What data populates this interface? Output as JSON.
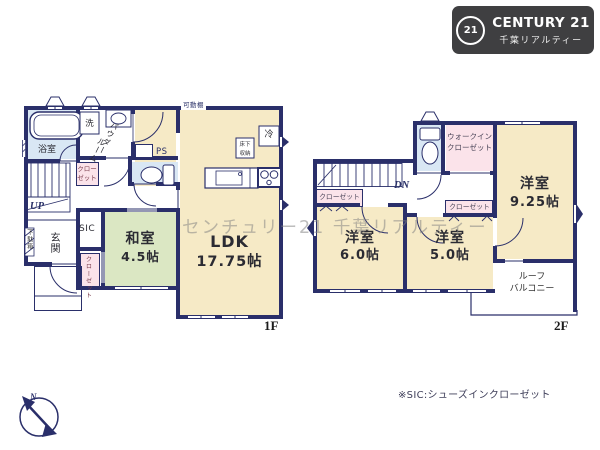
{
  "logo": {
    "seal": "21",
    "brand": "CENTURY 21",
    "subtitle": "千葉リアルティー"
  },
  "watermark": "センチュリー21 千葉リアルティー",
  "footnote": "※SIC:シューズインクローゼット",
  "compass": {
    "north": "N"
  },
  "colors": {
    "wall": "#2a2f6a",
    "room_cream": "#f6eac6",
    "room_green": "#dbe7c3",
    "room_blue": "#d9e7f4",
    "room_pink": "#fbe3ea",
    "logo_bg": "#3f3f41"
  },
  "icons": {
    "compass": "compass-icon",
    "bathtub": "bathtub-icon",
    "toilet": "toilet-icon",
    "kitchen": "kitchen-counter-icon",
    "stove": "stove-icon",
    "sink": "sink-icon"
  },
  "floor1": {
    "floor_label": "1F",
    "bath": "浴室",
    "laundry": "洗",
    "powder_line1": "パウダー",
    "powder_line2": "ルーム",
    "hall_closet": "クローゼット",
    "stairs": "UP",
    "shoe_box": "下駄箱",
    "entrance": "玄関",
    "sic": "SIC",
    "entrance_closet": "クローゼット",
    "japanese_room": "和室",
    "japanese_room_size": "4.5帖",
    "ldk": "LDK",
    "ldk_size": "17.75帖",
    "ps": "PS",
    "movable_shelf": "可動棚",
    "fridge": "冷",
    "underfloor_storage": "床下収納"
  },
  "floor2": {
    "floor_label": "2F",
    "stairs": "DN",
    "closet_left": "クローゼット",
    "walk_in_closet": "ウォークインクローゼット",
    "closet_center": "クローゼット",
    "bedroom_925": "洋室",
    "bedroom_925_size": "9.25帖",
    "bedroom_60": "洋室",
    "bedroom_60_size": "6.0帖",
    "bedroom_50": "洋室",
    "bedroom_50_size": "5.0帖",
    "roof_balcony_line1": "ルーフ",
    "roof_balcony_line2": "バルコニー"
  }
}
